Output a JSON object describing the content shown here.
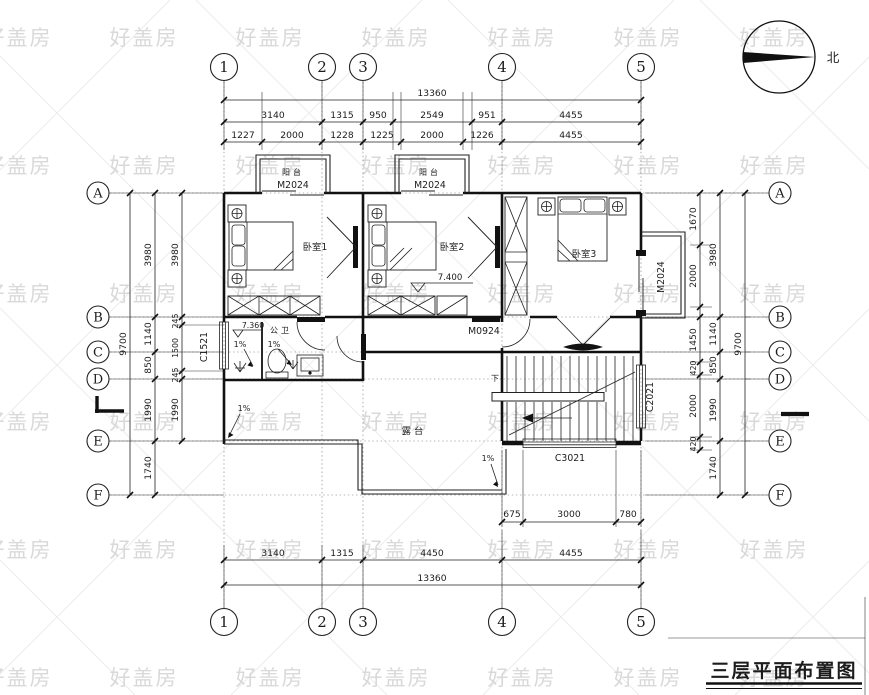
{
  "title": "三层平面布置图",
  "watermark": {
    "text": "好盖房"
  },
  "compass": {
    "north": "北"
  },
  "grid": {
    "cols": [
      "1",
      "2",
      "3",
      "4",
      "5"
    ],
    "rows": [
      "A",
      "B",
      "C",
      "D",
      "E",
      "F"
    ]
  },
  "dims": {
    "top_total": "13360",
    "top_row2": [
      "3140",
      "1315",
      "950",
      "2549",
      "951",
      "4455"
    ],
    "top_row3": [
      "1227",
      "2000",
      "1228",
      "1225",
      "2000",
      "1226",
      "4455"
    ],
    "bot_row1": [
      "675",
      "3000",
      "780"
    ],
    "bot_row2": [
      "3140",
      "1315",
      "4450",
      "4455"
    ],
    "bot_total": "13360",
    "left_total": "9700",
    "left_chain": [
      "3980",
      "1140",
      "850",
      "1990",
      "1740"
    ],
    "left_inner": [
      "3980",
      "245",
      "1500",
      "245",
      "1990"
    ],
    "right_total": "9700",
    "right_chain": [
      "3980",
      "1140",
      "850",
      "1990",
      "1740"
    ],
    "right_inner": [
      "1670",
      "2000",
      "1450",
      "420",
      "2000",
      "420"
    ]
  },
  "rooms": {
    "balcony": "阳台",
    "bed1": "卧室1",
    "bed2": "卧室2",
    "bed3": "卧室3",
    "bath": "公卫",
    "terrace": "露台"
  },
  "openings": {
    "m2024": "M2024",
    "m0924": "M0924",
    "c1521": "C1521",
    "c2021": "C2021",
    "c3021": "C3021"
  },
  "marks": {
    "level_bed2": "7.400",
    "level_bath": "7.360",
    "slope": "1%",
    "down": "下"
  }
}
